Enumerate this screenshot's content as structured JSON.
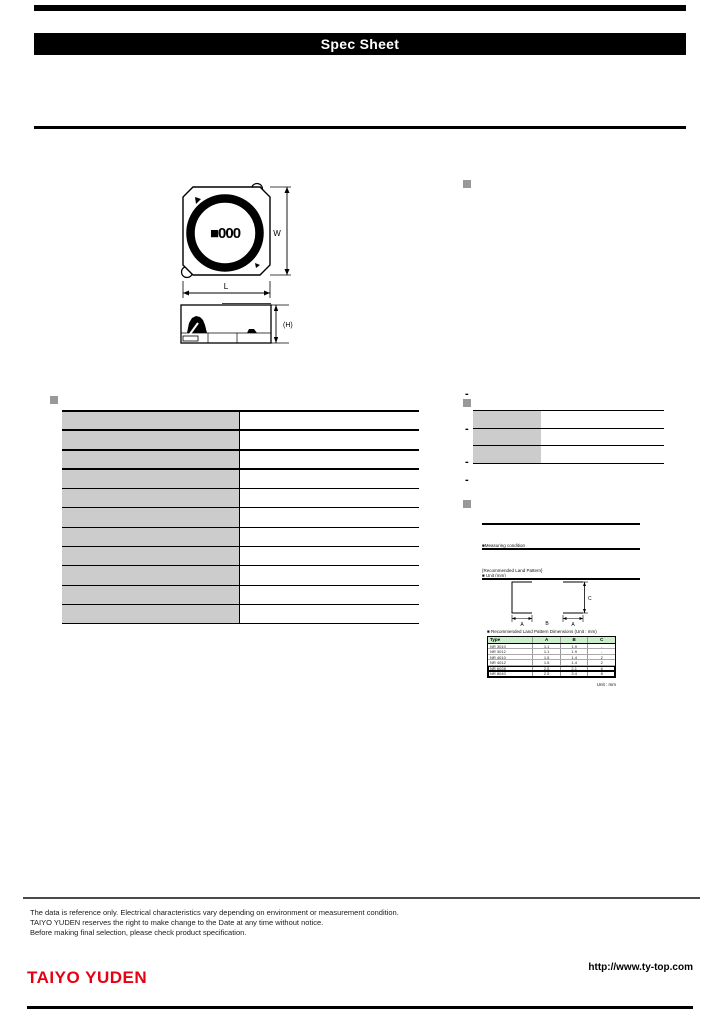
{
  "page": {
    "title_banner": "Spec Sheet"
  },
  "component_drawing": {
    "marking_text": "■000",
    "width_label": "W",
    "length_label": "L",
    "height_label": "(H)"
  },
  "features_section": {
    "bullets": [
      "-",
      "-",
      "-",
      "-"
    ]
  },
  "spec_table_left": {
    "rows": [
      {
        "label": "",
        "value": ""
      },
      {
        "label": "",
        "value": ""
      },
      {
        "label": "",
        "value": ""
      },
      {
        "label": "",
        "value": ""
      },
      {
        "label": "",
        "value": ""
      },
      {
        "label": "",
        "value": ""
      },
      {
        "label": "",
        "value": ""
      },
      {
        "label": "",
        "value": ""
      },
      {
        "label": "",
        "value": ""
      },
      {
        "label": "",
        "value": ""
      },
      {
        "label": "",
        "value": ""
      }
    ]
  },
  "info_table_right": {
    "rows": [
      {
        "label": "",
        "value": ""
      },
      {
        "label": "",
        "value": ""
      },
      {
        "label": "",
        "value": ""
      }
    ]
  },
  "notes_section": {
    "block1_lines": [
      "■Measuring condition",
      "   (for reference)",
      "   Inductance : Agilent 4285A or equivalent   (Test frequency / Test level : 100kHz, 1V)",
      "   DC resistance : Milliohm meter or equivalent   (Ambient temperature : 20°C)"
    ],
    "block2_lines": [
      "{Recommended Land Pattern}",
      "■ Unit (mm)",
      "The land pattern design shown below is recommended for reflow soldering.",
      "Available to use the standard land pattern for each type as described in the table below."
    ],
    "land_pattern": {
      "dim_a_left": "A",
      "dim_a_right": "A",
      "dim_b": "B",
      "dim_c": "C"
    },
    "land_pattern_table": {
      "title": "■ Recommended Land Pattern Dimensions (Unit : mm)",
      "headers": [
        "Type",
        "A",
        "B",
        "C"
      ],
      "rows": [
        {
          "type": "NR 3010",
          "a": "1.1",
          "b": "1.9",
          "c": "-",
          "boxed": false
        },
        {
          "type": "NR 3012",
          "a": "1.1",
          "b": "1.9",
          "c": "-",
          "boxed": false
        },
        {
          "type": "NR 4010",
          "a": "1.5",
          "b": "1.4",
          "c": "2",
          "boxed": false
        },
        {
          "type": "NR 4012",
          "a": "1.5",
          "b": "1.4",
          "c": "2",
          "boxed": false
        },
        {
          "type": "NR 6028",
          "a": "2.5",
          "b": "2.1",
          "c": "6",
          "boxed": true
        },
        {
          "type": "NR 8040",
          "a": "2.5",
          "b": "3.4",
          "c": "8",
          "boxed": true
        }
      ],
      "footnote": "Unit : mm"
    }
  },
  "footer": {
    "disclaimer_lines": [
      "The data is reference only. Electrical characteristics vary depending on environment or measurement condition.",
      "TAIYO YUDEN reserves the right to make change to the Date at any time without notice.",
      "Before making final selection, please check product specification."
    ],
    "logo_text": "TAIYO YUDEN",
    "website_url": "http://www.ty-top.com"
  },
  "colors": {
    "logo_red": "#e60012",
    "cell_gray": "#cccccc",
    "marker_gray": "#999999",
    "lp_header_green": "#c9eec9"
  }
}
